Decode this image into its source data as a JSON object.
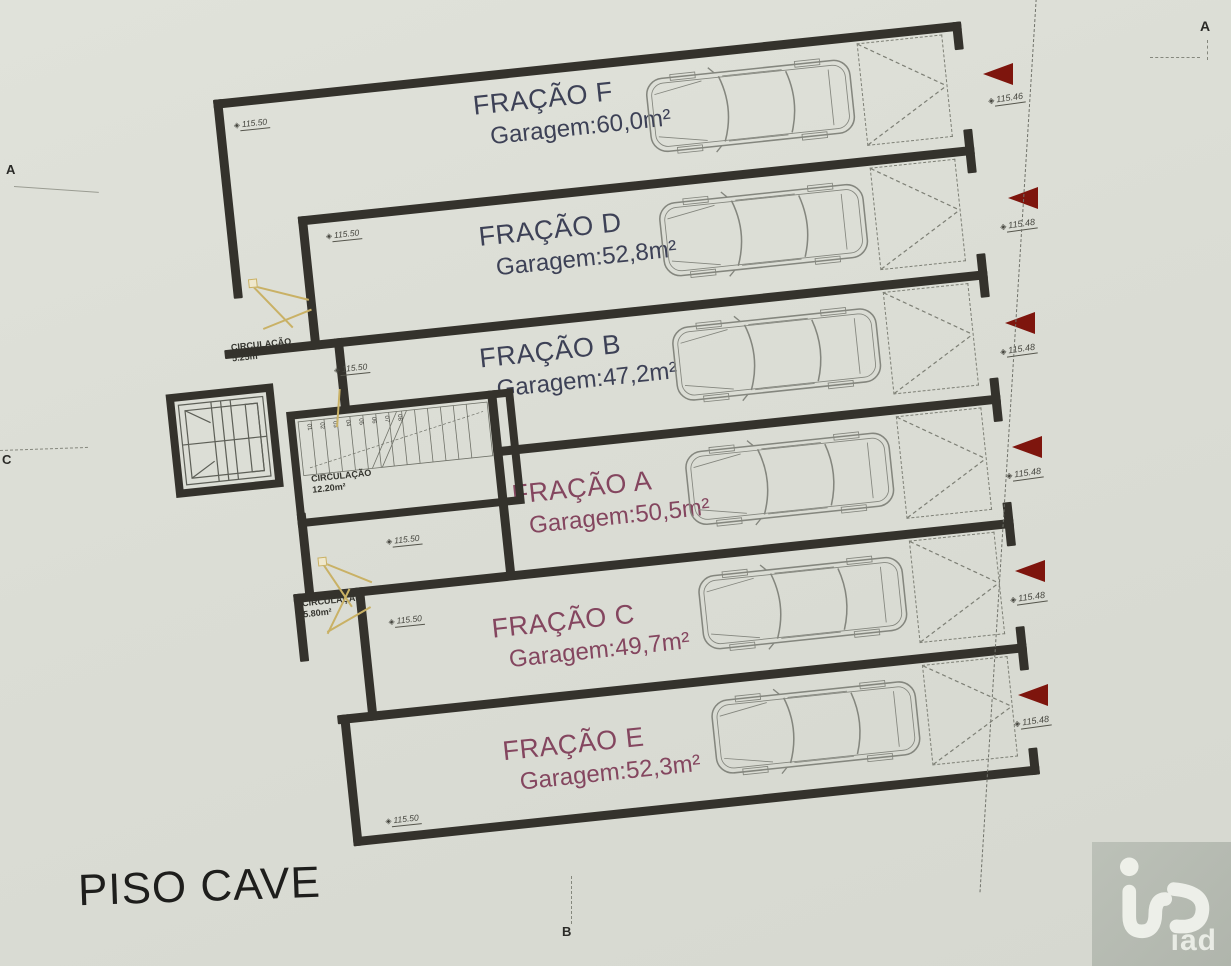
{
  "page": {
    "title": "PISO CAVE"
  },
  "fractions": [
    {
      "name": "FRAÇÃO F",
      "area": "Garagem:60,0m²",
      "elevation": "115.46",
      "color": "navy"
    },
    {
      "name": "FRAÇÃO D",
      "area": "Garagem:52,8m²",
      "elevation": "115.48",
      "color": "navy"
    },
    {
      "name": "FRAÇÃO B",
      "area": "Garagem:47,2m²",
      "elevation": "115.48",
      "color": "navy"
    },
    {
      "name": "FRAÇÃO A",
      "area": "Garagem:50,5m²",
      "elevation": "115.48",
      "color": "plum"
    },
    {
      "name": "FRAÇÃO C",
      "area": "Garagem:49,7m²",
      "elevation": "115.48",
      "color": "plum"
    },
    {
      "name": "FRAÇÃO E",
      "area": "Garagem:52,3m²",
      "elevation": "115.48",
      "color": "plum"
    }
  ],
  "circulation": [
    {
      "label": "CIRCULAÇÃO",
      "area": "5.25m²"
    },
    {
      "label": "CIRCULAÇÃO",
      "area": "12.20m²"
    },
    {
      "label": "CIRCULAÇÃO",
      "area": "5.80m²"
    }
  ],
  "interior_elevations": [
    "115.50",
    "115.50",
    "115.50",
    "115.50",
    "115.50",
    "115.50"
  ],
  "stair_steps": [
    "01",
    "02",
    "03",
    "04",
    "05",
    "06",
    "07",
    "08"
  ],
  "grid_markers": {
    "left_top": "A",
    "left_middle": "C",
    "top_right": "A",
    "bottom_center": "B"
  },
  "benchmark_glyph": "◈",
  "logo_text": "iad",
  "colors": {
    "paper": "#dcded6",
    "wall": "#34322c",
    "navy_label": "#3d4156",
    "plum_label": "#84465f",
    "red_arrow": "#7e150d",
    "door_swing": "#c9b165",
    "logo_bg": "#b6bbb2"
  }
}
